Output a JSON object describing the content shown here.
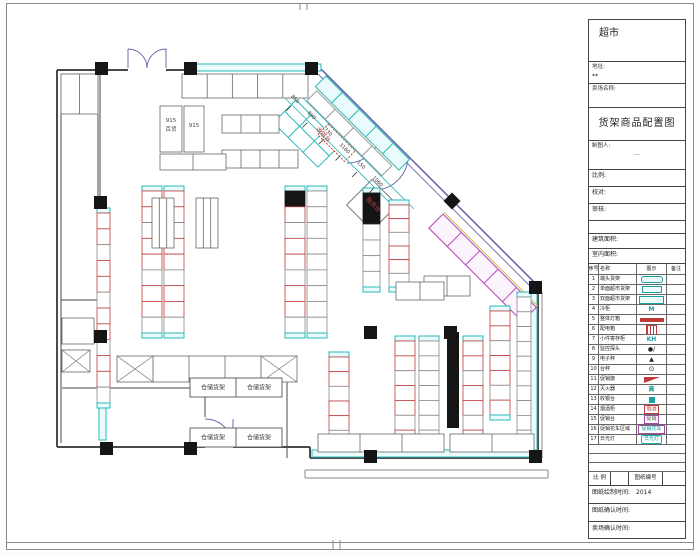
{
  "title_block": {
    "store_type": "超市",
    "address_label": "地址:",
    "address_value": "**",
    "store_name_label": "卖场名称:",
    "drawing_title": "货架商品配置图",
    "drafter_label": "制图人:",
    "drafter_value": "···",
    "fields": [
      {
        "label": "比例:"
      },
      {
        "label": "校对:"
      },
      {
        "label": "审核:"
      },
      {
        "label": ""
      },
      {
        "label": "建筑面积:"
      },
      {
        "label": "室内面积:"
      }
    ],
    "legend": {
      "headers": [
        "序号",
        "名称",
        "图示",
        "备注"
      ],
      "rows": [
        {
          "no": "1",
          "name": "端头货架",
          "icon": "pill"
        },
        {
          "no": "2",
          "name": "单面超市货架",
          "icon": "rect"
        },
        {
          "no": "3",
          "name": "双面超市货架",
          "icon": "rectw"
        },
        {
          "no": "4",
          "name": "冷柜",
          "icon": "tteal",
          "glyph": "M"
        },
        {
          "no": "5",
          "name": "整体灯箱",
          "icon": "barred"
        },
        {
          "no": "6",
          "name": "配电箱",
          "icon": "gridred"
        },
        {
          "no": "7",
          "name": "小件寄存柜",
          "icon": "tteal",
          "glyph": "KH"
        },
        {
          "no": "8",
          "name": "监控探头",
          "icon": "dot",
          "glyph": "●/"
        },
        {
          "no": "9",
          "name": "电子秤",
          "icon": "tri",
          "glyph": "▲"
        },
        {
          "no": "10",
          "name": "台秤",
          "icon": "cdot",
          "glyph": "⊙"
        },
        {
          "no": "11",
          "name": "促销旗",
          "icon": "flag"
        },
        {
          "no": "12",
          "name": "灭火器",
          "icon": "tteal",
          "glyph": "高"
        },
        {
          "no": "13",
          "name": "收银台",
          "icon": "sqteal"
        },
        {
          "no": "14",
          "name": "烟酒柜",
          "icon": "boxred",
          "glyph": "烟酒"
        },
        {
          "no": "15",
          "name": "促销台",
          "icon": "boxpur",
          "glyph": "促销"
        },
        {
          "no": "16",
          "name": "促销花车区域",
          "icon": "boxpurw",
          "glyph": "促销花车"
        },
        {
          "no": "17",
          "name": "日光灯",
          "icon": "boxcynw",
          "glyph": "日光灯"
        }
      ],
      "empty_rows": 3
    },
    "footer": {
      "scale_label": "比 例",
      "scale_value": "",
      "number_label": "图纸编号",
      "number_value": "",
      "time_rows": [
        {
          "label": "图纸绘制时间:",
          "value": "2014"
        },
        {
          "label": "图纸确认时间:",
          "value": ""
        },
        {
          "label": "卖场确认时间:",
          "value": ""
        }
      ]
    }
  },
  "plan": {
    "colors": {
      "wall": "#4a4a4a",
      "column": "#151515",
      "cyan": "#2bb8b8",
      "cyan_fill": "#e9fbfb",
      "red": "#c03a3a",
      "magenta": "#bb4ab8",
      "purple": "#6b6bab",
      "gray": "#8a8a8a",
      "yellow": "#cfc04a"
    },
    "storage_label": "仓储货架",
    "diag_labels": [
      {
        "text": "收银台",
        "x": 322,
        "y": 136
      },
      {
        "text": "服务台",
        "x": 372,
        "y": 206
      }
    ],
    "text_labels": [
      {
        "text": "915",
        "x": 171,
        "y": 122
      },
      {
        "text": "百货",
        "x": 171,
        "y": 131
      },
      {
        "text": "915",
        "x": 194,
        "y": 127
      }
    ],
    "dimensions": [
      "860",
      "890",
      "730",
      "3160",
      "150",
      "1060"
    ],
    "gondolas": [
      {
        "x": 142,
        "y": 186,
        "h": 152,
        "cells": 9,
        "style": "red"
      },
      {
        "x": 164,
        "y": 186,
        "h": 152,
        "cells": 9,
        "style": "red"
      },
      {
        "x": 285,
        "y": 186,
        "h": 152,
        "cells": 9,
        "style": "red",
        "black": 1
      },
      {
        "x": 307,
        "y": 186,
        "h": 152,
        "cells": 9,
        "style": "plain"
      },
      {
        "x": 363,
        "y": 188,
        "h": 104,
        "cells": 6,
        "style": "plain",
        "black": 2,
        "w": 17
      },
      {
        "x": 389,
        "y": 200,
        "h": 92,
        "cells": 6,
        "style": "red"
      },
      {
        "x": 490,
        "y": 306,
        "h": 114,
        "cells": 7,
        "style": "red"
      },
      {
        "x": 329,
        "y": 352,
        "h": 98,
        "cells": 6,
        "style": "red"
      },
      {
        "x": 395,
        "y": 336,
        "h": 114,
        "cells": 7,
        "style": "red"
      },
      {
        "x": 419,
        "y": 336,
        "h": 114,
        "cells": 7,
        "style": "plain"
      },
      {
        "x": 463,
        "y": 336,
        "h": 114,
        "cells": 7,
        "style": "red"
      },
      {
        "x": 97,
        "y": 208,
        "h": 200,
        "cells": 12,
        "style": "red",
        "w": 13
      },
      {
        "x": 517,
        "y": 292,
        "h": 158,
        "cells": 10,
        "style": "plain",
        "w": 14
      }
    ],
    "shelf_rows": [
      {
        "x": 182,
        "y": 74,
        "w": 126,
        "h": 24,
        "cells": 5
      },
      {
        "x": 222,
        "y": 115,
        "w": 57,
        "h": 18,
        "cells": 3
      },
      {
        "x": 222,
        "y": 150,
        "w": 76,
        "h": 18,
        "cells": 4
      },
      {
        "x": 160,
        "y": 106,
        "w": 22,
        "h": 46,
        "cells": 1
      },
      {
        "x": 184,
        "y": 106,
        "w": 20,
        "h": 46,
        "cells": 1
      },
      {
        "x": 160,
        "y": 154,
        "w": 66,
        "h": 16,
        "cells": 2
      },
      {
        "x": 152,
        "y": 198,
        "w": 22,
        "h": 50,
        "cells": 3
      },
      {
        "x": 196,
        "y": 198,
        "w": 22,
        "h": 50,
        "cells": 3
      },
      {
        "x": 318,
        "y": 434,
        "w": 126,
        "h": 18,
        "cells": 3
      },
      {
        "x": 450,
        "y": 434,
        "w": 84,
        "h": 18,
        "cells": 2
      },
      {
        "x": 424,
        "y": 276,
        "w": 46,
        "h": 20,
        "cells": 2
      },
      {
        "x": 396,
        "y": 282,
        "w": 48,
        "h": 18,
        "cells": 2
      },
      {
        "x": 61,
        "y": 74,
        "w": 37,
        "h": 40,
        "cells": 2
      },
      {
        "x": 153,
        "y": 356,
        "w": 108,
        "h": 26,
        "cells": 3
      },
      {
        "x": 62,
        "y": 318,
        "w": 32,
        "h": 26,
        "cells": 1
      }
    ],
    "x_boxes": [
      {
        "x": 117,
        "y": 356,
        "w": 36,
        "h": 26
      },
      {
        "x": 261,
        "y": 356,
        "w": 36,
        "h": 26
      },
      {
        "x": 62,
        "y": 350,
        "w": 28,
        "h": 22
      }
    ],
    "storage_boxes": [
      {
        "x": 190,
        "y": 378,
        "w": 46,
        "h": 19
      },
      {
        "x": 236,
        "y": 378,
        "w": 46,
        "h": 19
      },
      {
        "x": 190,
        "y": 428,
        "w": 46,
        "h": 19
      },
      {
        "x": 236,
        "y": 428,
        "w": 46,
        "h": 19
      }
    ],
    "columns": [
      [
        95,
        62
      ],
      [
        184,
        62
      ],
      [
        305,
        62
      ],
      [
        94,
        196
      ],
      [
        94,
        330
      ],
      [
        100,
        442
      ],
      [
        184,
        442
      ],
      [
        364,
        326
      ],
      [
        444,
        326
      ],
      [
        364,
        450
      ],
      [
        529,
        450
      ],
      [
        529,
        281
      ]
    ],
    "black_bars": [
      {
        "x": 447,
        "y": 332,
        "w": 12,
        "h": 96
      }
    ]
  }
}
